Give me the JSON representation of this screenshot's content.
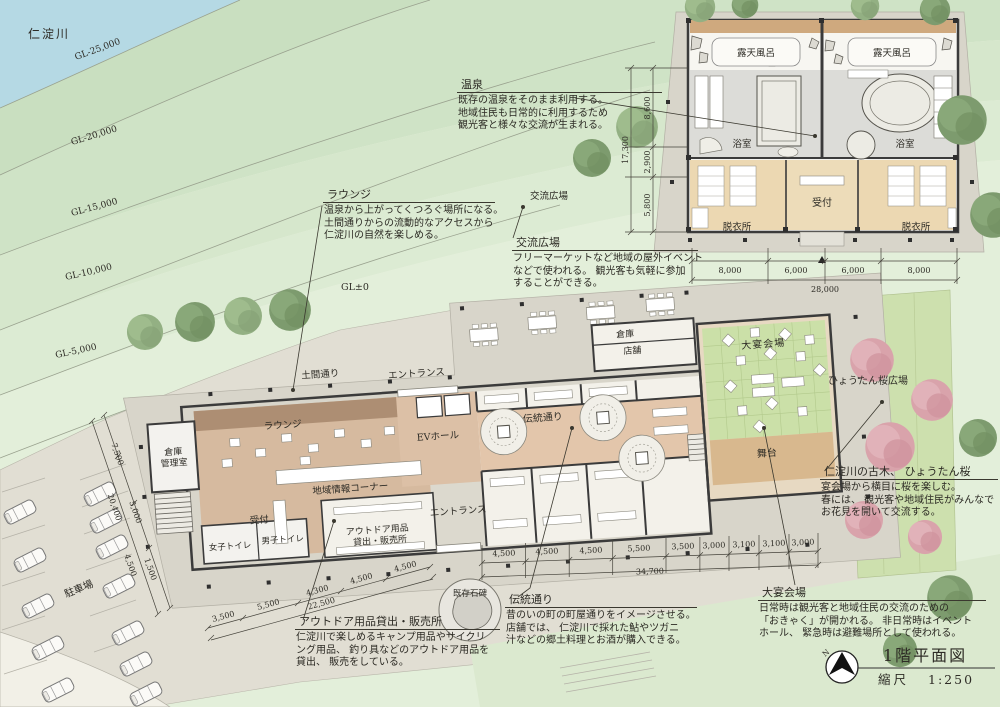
{
  "title_block": {
    "title": "1階平面図",
    "scale_label": "縮尺",
    "scale_value": "1:250",
    "north": "N"
  },
  "site": {
    "river": "仁淀川",
    "contours": [
      "GL-25,000",
      "GL-20,000",
      "GL-15,000",
      "GL-10,000",
      "GL-5,000",
      "GL±0"
    ],
    "parking": "駐車場",
    "stone": "既存石碑",
    "sakura_plaza": "ひょうたん桜広場",
    "koryu_plaza": "交流広場"
  },
  "rooms": {
    "doma": "土間通り",
    "entrance_top": "エントランス",
    "lounge": "ラウンジ",
    "warehouse_1": "倉庫",
    "warehouse_2": "管理室",
    "ev_hall": "EVホール",
    "info": "地域情報コーナー",
    "reception": "受付",
    "outdoor_1": "アウトドア用品",
    "outdoor_2": "貸出・販売所",
    "entrance_south": "エントランス",
    "wc_women": "女子トイレ",
    "wc_men": "男子トイレ",
    "dento": "伝統通り",
    "storage": "倉庫",
    "shop": "店舗",
    "banquet": "大宴会場",
    "stage": "舞台"
  },
  "onsen_rooms": {
    "rotenburo_l": "露天風呂",
    "rotenburo_r": "露天風呂",
    "bath_l": "浴室",
    "bath_r": "浴室",
    "reception": "受付",
    "dressing_l": "脱衣所",
    "dressing_r": "脱衣所"
  },
  "annotations": {
    "onsen": {
      "title": "温泉",
      "lines": [
        "既存の温泉をそのまま利用する。",
        "地域住民も日常的に利用するため",
        "観光客と様々な交流が生まれる。"
      ]
    },
    "lounge": {
      "title": "ラウンジ",
      "lines": [
        "温泉から上がってくつろぐ場所になる。",
        "土間通りからの流動的なアクセスから",
        "仁淀川の自然を楽しめる。"
      ]
    },
    "koryu": {
      "title": "交流広場",
      "lines": [
        "フリーマーケットなど地域の屋外イベント",
        "などで使われる。 観光客も気軽に参加",
        "することができる。"
      ]
    },
    "sakura": {
      "title": "仁淀川の古木、 ひょうたん桜",
      "lines": [
        "宴会場から横目に桜を楽しむ。",
        "春には、 観光客や地域住民がみんなで",
        "お花見を開いて交流する。"
      ]
    },
    "outdoor": {
      "title": "アウトドア用品貸出・販売所",
      "lines": [
        "仁淀川で楽しめるキャンプ用品やサイクリ",
        "ング用品、 釣り具などのアウトドア用品を",
        "貸出、 販売をしている。"
      ]
    },
    "dento": {
      "title": "伝統通り",
      "lines": [
        "昔のいの町の町屋通りをイメージさせる。",
        "店舗では、 仁淀川で採れた鮎やツガニ",
        "汁などの郷土料理とお酒が購入できる。"
      ]
    },
    "banquet": {
      "title": "大宴会場",
      "lines": [
        "日常時は観光客と地域住民の交流のための",
        "「おきゃく」が開かれる。 非日常時はイベント",
        "ホール、 緊急時は避難場所として使われる。"
      ]
    }
  },
  "dims": {
    "onsen_bottom": [
      "8,000",
      "6,000",
      "6,000",
      "8,000"
    ],
    "onsen_bottom_total": "28,000",
    "onsen_left": [
      "8,600",
      "2,900",
      "5,800"
    ],
    "onsen_left_total": "17,300",
    "main_bottom": [
      "4,500",
      "4,500",
      "4,500",
      "5,500",
      "3,500",
      "3,000",
      "3,100",
      "3,100",
      "3,000"
    ],
    "main_bottom_total": "34,700",
    "southwest": [
      "3,500",
      "5,500",
      "4,300",
      "4,500",
      "4,500"
    ],
    "southwest_total": "22,500",
    "west_side": [
      "7,500",
      "5,000",
      "1,500"
    ],
    "west_side_outer": [
      "20,400",
      "4,500"
    ]
  },
  "colors": {
    "river": "#b5d9e4",
    "slope_green": "#cfe3c6",
    "paving": "#e1ded3",
    "deck": "#d8d5ca",
    "floor_tan": "#d6ba9f",
    "doma_brown": "#ad8e73",
    "tatami_green": "#cbe0a8",
    "dressing_tan": "#ecd8b2",
    "wall": "#3b3b3b",
    "cherry_pink": "#d9a3ab"
  }
}
